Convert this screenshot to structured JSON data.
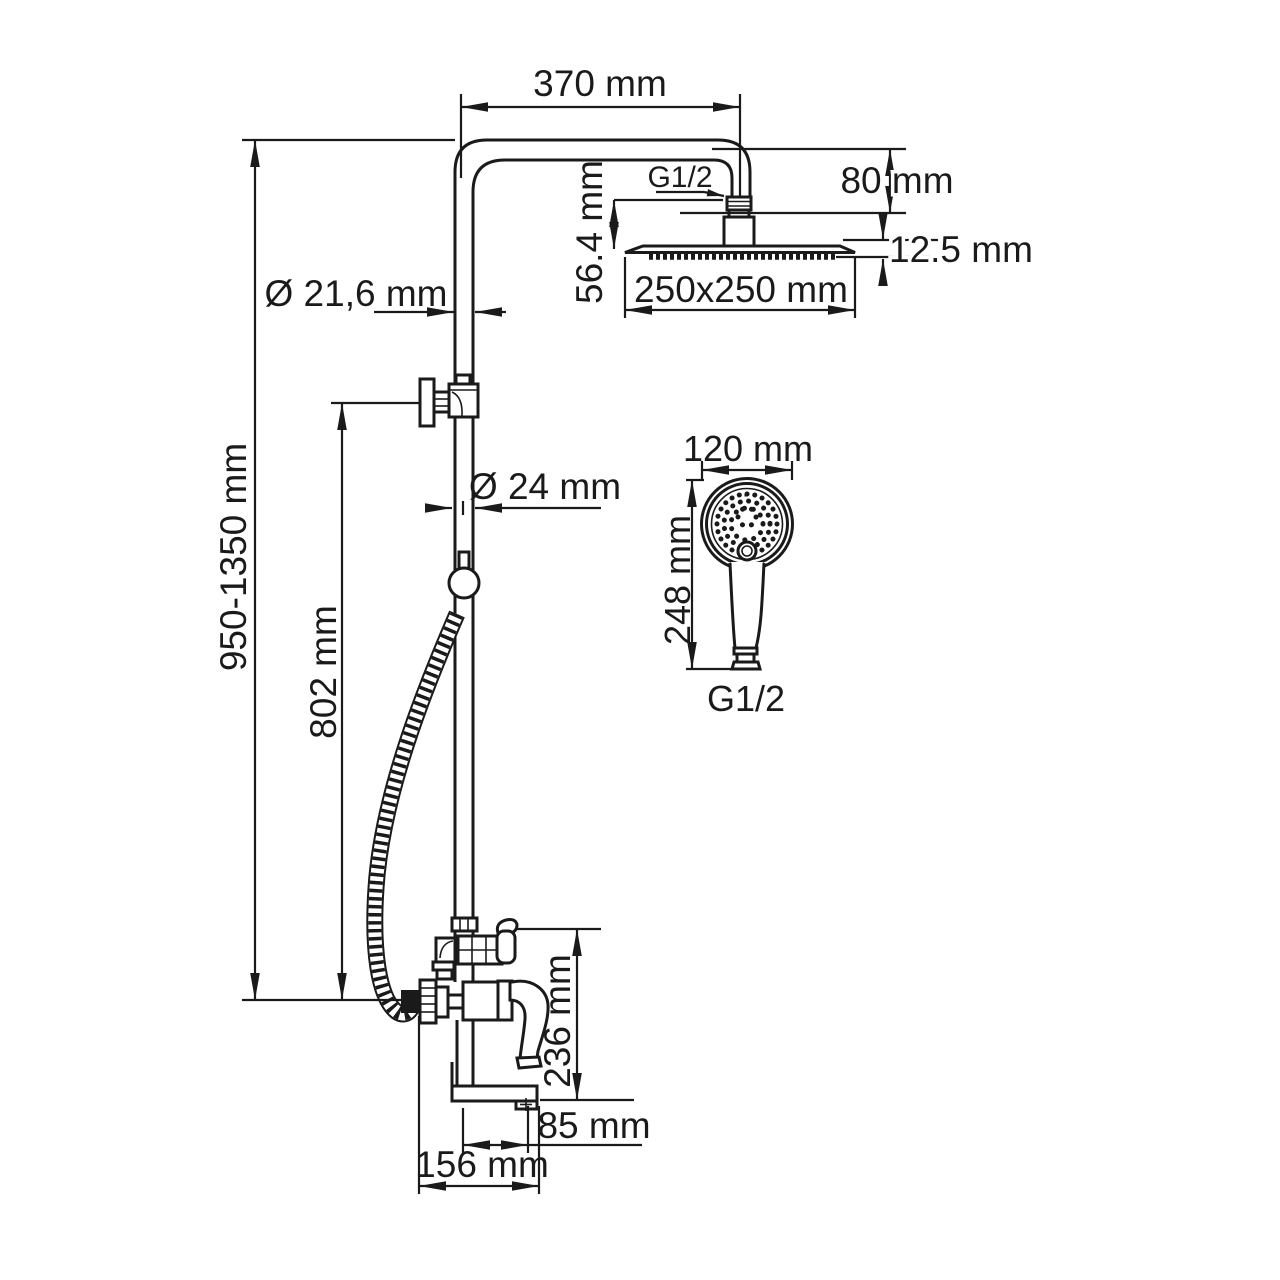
{
  "meta": {
    "description": "Technical dimensional drawing of a shower column system with overhead rain shower, hand shower, diverter and bath spout mixer",
    "background_color": "#ffffff",
    "line_color": "#1a1a1a"
  },
  "labels": {
    "arm_length": "370 mm",
    "arm_drop": "80 mm",
    "head_thread": "G1/2",
    "head_offset": "56.4 mm",
    "head_thickness": "12.5 mm",
    "head_size": "250x250 mm",
    "upper_pipe_diameter": "Ø 21,6 mm",
    "lower_pipe_diameter": "Ø 24 mm",
    "column_height": "950-1350 mm",
    "hose_outlet_height": "802 mm",
    "hand_shower_diameter": "120 mm",
    "hand_shower_length": "248 mm",
    "hand_shower_thread": "G1/2",
    "mixer_height": "236 mm",
    "spout_reach": "85 mm",
    "mixer_width": "156 mm"
  }
}
